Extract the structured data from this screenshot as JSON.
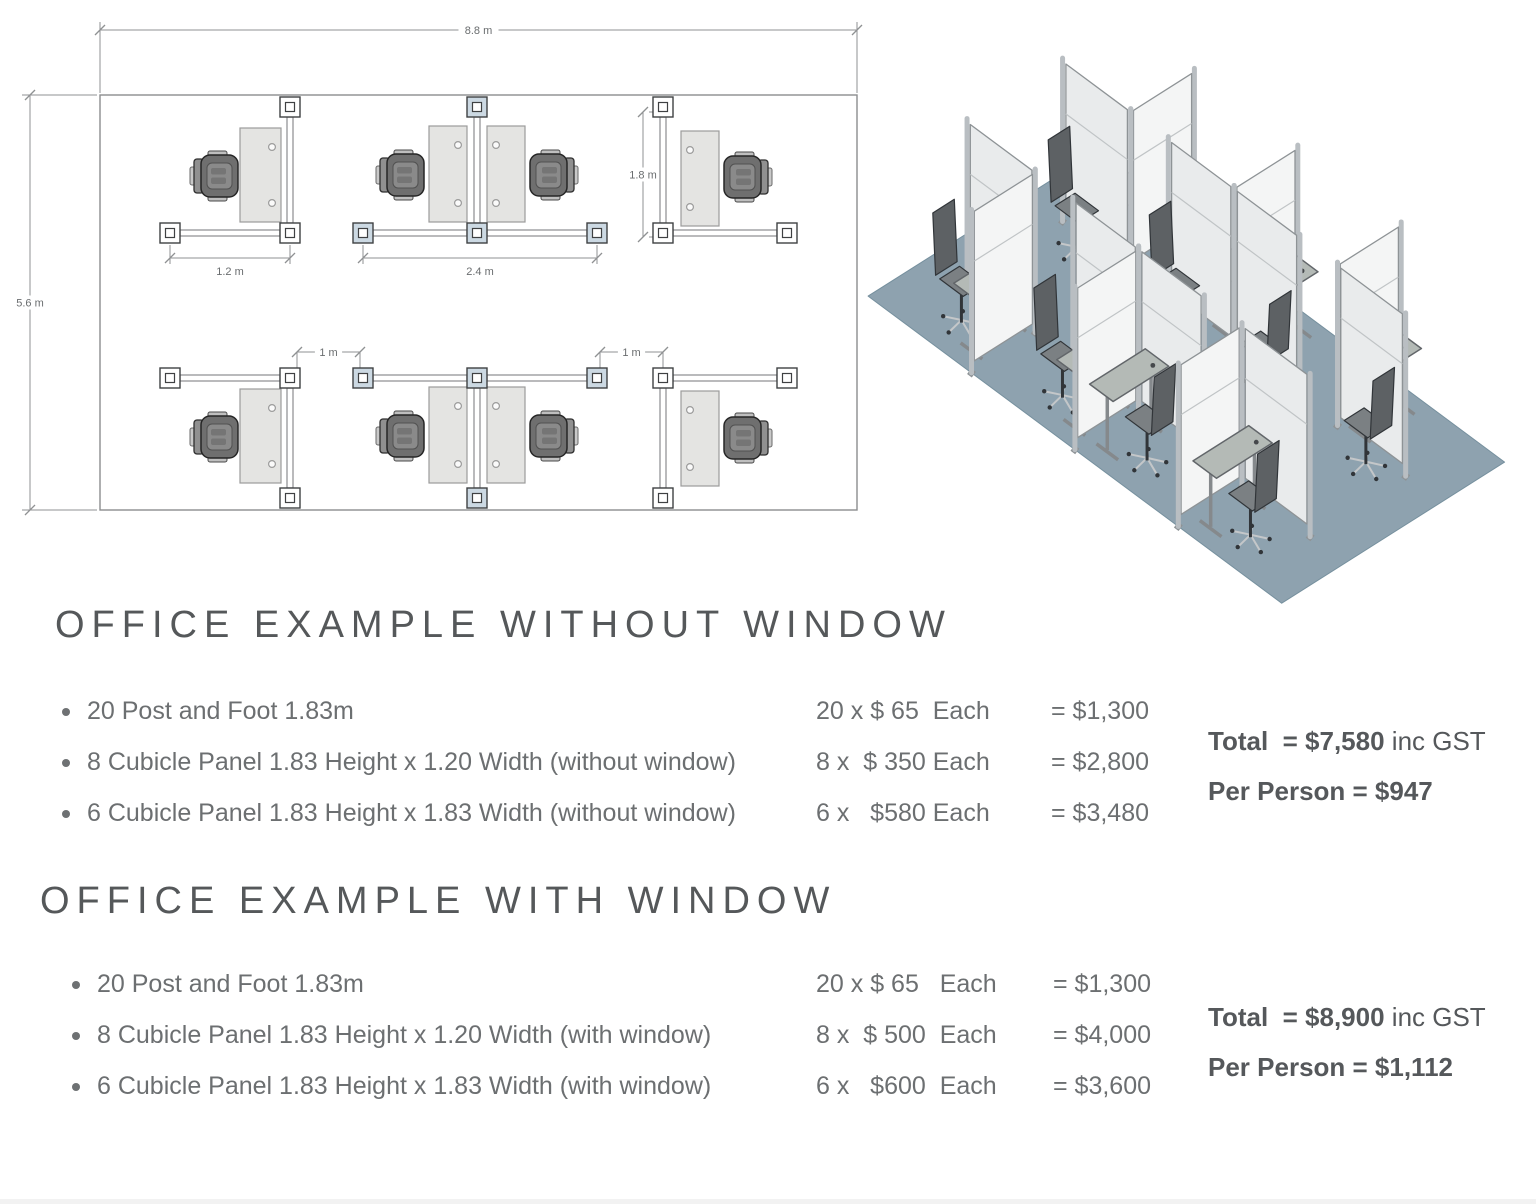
{
  "floor_plan": {
    "room": {
      "x": 100,
      "y": 95,
      "w": 757,
      "h": 415
    },
    "colors": {
      "line": "#8b8d8f",
      "dim": "#8f9193",
      "text": "#6a6d6f",
      "post_line": "#3f4143",
      "post_shaded": "#ccd9e3",
      "desk": "#e4e4e2",
      "desk_line": "#9b9b9b"
    },
    "dims": [
      {
        "x1": 100,
        "y1": 30,
        "x2": 857,
        "y2": 30,
        "label": "8.8 m",
        "ext": [
          [
            100,
            22,
            100,
            93
          ],
          [
            857,
            22,
            857,
            93
          ]
        ]
      },
      {
        "x1": 30,
        "y1": 95,
        "x2": 30,
        "y2": 510,
        "label": "5.6 m",
        "ext": [
          [
            22,
            95,
            97,
            95
          ],
          [
            22,
            510,
            97,
            510
          ]
        ]
      },
      {
        "x1": 170,
        "y1": 258,
        "x2": 290,
        "y2": 258,
        "label": "1.2 m",
        "below": true,
        "ext": [
          [
            170,
            245,
            170,
            264
          ],
          [
            290,
            245,
            290,
            264
          ]
        ]
      },
      {
        "x1": 363,
        "y1": 258,
        "x2": 597,
        "y2": 258,
        "label": "2.4 m",
        "below": true,
        "ext": [
          [
            363,
            245,
            363,
            264
          ],
          [
            597,
            245,
            597,
            264
          ]
        ]
      },
      {
        "x1": 643,
        "y1": 112,
        "x2": 643,
        "y2": 237,
        "label": "1.8 m",
        "ext": [
          [
            649,
            112,
            671,
            112
          ],
          [
            649,
            237,
            671,
            237
          ]
        ]
      },
      {
        "x1": 297,
        "y1": 352,
        "x2": 360,
        "y2": 352,
        "label": "1 m",
        "ext": [
          [
            297,
            352,
            297,
            370
          ],
          [
            360,
            352,
            360,
            370
          ]
        ]
      },
      {
        "x1": 600,
        "y1": 352,
        "x2": 663,
        "y2": 352,
        "label": "1 m",
        "ext": [
          [
            600,
            352,
            600,
            370
          ],
          [
            663,
            352,
            663,
            370
          ]
        ]
      }
    ],
    "panels": [
      [
        290,
        117,
        290,
        223
      ],
      [
        477,
        117,
        477,
        223
      ],
      [
        663,
        117,
        663,
        223
      ],
      [
        180,
        233,
        280,
        233
      ],
      [
        373,
        233,
        467,
        233
      ],
      [
        487,
        233,
        587,
        233
      ],
      [
        673,
        233,
        777,
        233
      ],
      [
        290,
        388,
        290,
        488
      ],
      [
        477,
        388,
        477,
        488
      ],
      [
        663,
        388,
        663,
        488
      ],
      [
        180,
        378,
        280,
        378
      ],
      [
        373,
        378,
        467,
        378
      ],
      [
        487,
        378,
        587,
        378
      ],
      [
        673,
        378,
        777,
        378
      ]
    ],
    "posts": [
      [
        290,
        107,
        0
      ],
      [
        477,
        107,
        1
      ],
      [
        663,
        107,
        0
      ],
      [
        170,
        233,
        0
      ],
      [
        290,
        233,
        0
      ],
      [
        363,
        233,
        1
      ],
      [
        477,
        233,
        1
      ],
      [
        597,
        233,
        1
      ],
      [
        663,
        233,
        0
      ],
      [
        787,
        233,
        0
      ],
      [
        170,
        378,
        0
      ],
      [
        290,
        378,
        0
      ],
      [
        363,
        378,
        1
      ],
      [
        477,
        378,
        1
      ],
      [
        597,
        378,
        1
      ],
      [
        663,
        378,
        0
      ],
      [
        787,
        378,
        0
      ],
      [
        290,
        498,
        0
      ],
      [
        477,
        498,
        1
      ],
      [
        663,
        498,
        0
      ]
    ],
    "desks": [
      [
        240,
        128,
        41,
        94,
        "r"
      ],
      [
        429,
        126,
        38,
        96,
        "r"
      ],
      [
        487,
        126,
        38,
        96,
        "l"
      ],
      [
        681,
        131,
        38,
        95,
        "l"
      ],
      [
        240,
        389,
        41,
        94,
        "r"
      ],
      [
        429,
        387,
        38,
        96,
        "r"
      ],
      [
        487,
        387,
        38,
        96,
        "l"
      ],
      [
        681,
        391,
        38,
        95,
        "l"
      ]
    ],
    "chairs": [
      [
        217,
        176,
        0
      ],
      [
        403,
        175,
        0
      ],
      [
        551,
        175,
        180
      ],
      [
        745,
        177,
        180
      ],
      [
        217,
        437,
        0
      ],
      [
        403,
        436,
        0
      ],
      [
        551,
        436,
        180
      ],
      [
        745,
        438,
        180
      ]
    ]
  },
  "iso_view": {
    "proj": {
      "ox": 251,
      "oy": 115,
      "ax": 47.0,
      "ay": 34.9,
      "bx": 39.8,
      "by": 25.2,
      "hz": 86
    },
    "floor": [
      [
        0,
        0
      ],
      [
        8.8,
        0
      ],
      [
        8.8,
        5.6
      ],
      [
        0,
        5.6
      ]
    ],
    "colors": {
      "floor": "#8ea2af",
      "floor_line": "#76909e",
      "panel_front": "#e9ebec",
      "panel_side": "#f4f5f5",
      "panel_line": "#8e9396",
      "seam": "#c0c4c6",
      "post": "#b9bec2",
      "post_dark": "#8e9396",
      "desk": "#b4bab6",
      "desk_line": "#62666a",
      "leg": "#85898c",
      "chair_seat": "#7b8083",
      "chair_back": "#5d6164",
      "chair_dark": "#313539",
      "chair_base": "#c4c7c9"
    },
    "panels": [
      [
        2.2,
        0,
        2.2,
        1.6
      ],
      [
        4.4,
        0,
        4.4,
        1.6
      ],
      [
        6.6,
        0,
        6.6,
        1.6
      ],
      [
        0.75,
        1.6,
        2.2,
        1.6
      ],
      [
        3.0,
        1.6,
        4.4,
        1.6
      ],
      [
        4.4,
        1.6,
        5.8,
        1.6
      ],
      [
        6.6,
        1.6,
        8.05,
        1.6
      ],
      [
        2.2,
        4,
        2.2,
        5.6
      ],
      [
        4.4,
        4,
        4.4,
        5.6
      ],
      [
        6.6,
        4,
        6.6,
        5.6
      ],
      [
        0.75,
        4,
        2.2,
        4
      ],
      [
        3.0,
        4,
        4.4,
        4
      ],
      [
        4.4,
        4,
        5.8,
        4
      ],
      [
        6.6,
        4,
        8.05,
        4
      ]
    ],
    "desks": [
      [
        1.86,
        0.9
      ],
      [
        4.05,
        0.9
      ],
      [
        4.75,
        0.9
      ],
      [
        6.95,
        0.9
      ],
      [
        1.86,
        4.65
      ],
      [
        4.05,
        4.65
      ],
      [
        4.75,
        4.65
      ],
      [
        6.95,
        4.65
      ]
    ],
    "chairs": [
      [
        1.35,
        1.95,
        1
      ],
      [
        3.5,
        1.95,
        1
      ],
      [
        5.3,
        1.95,
        -1
      ],
      [
        7.5,
        1.95,
        -1
      ],
      [
        1.35,
        4.85,
        1
      ],
      [
        3.5,
        4.85,
        1
      ],
      [
        5.3,
        4.85,
        -1
      ],
      [
        7.5,
        4.85,
        -1
      ]
    ]
  },
  "sections": [
    {
      "title": "OFFICE EXAMPLE WITHOUT WINDOW",
      "items": [
        {
          "desc": "20 Post and Foot 1.83m",
          "qty": "20 x $ 65  Each",
          "total": "= $1,300"
        },
        {
          "desc": "8 Cubicle Panel 1.83 Height x 1.20 Width (without window)",
          "qty": "8 x  $ 350 Each",
          "total": "= $2,800"
        },
        {
          "desc": "6 Cubicle Panel 1.83 Height x 1.83 Width (without window)",
          "qty": "6 x   $580 Each",
          "total": "= $3,480"
        }
      ],
      "summary": {
        "total_bold": "Total  = $7,580",
        "total_suffix": " inc GST",
        "per_bold": "Per Person = $947"
      }
    },
    {
      "title": "OFFICE EXAMPLE WITH WINDOW",
      "items": [
        {
          "desc": "20 Post and Foot 1.83m",
          "qty": "20 x $ 65   Each",
          "total": "= $1,300"
        },
        {
          "desc": "8 Cubicle Panel 1.83 Height x 1.20 Width (with window)",
          "qty": "8 x  $ 500  Each",
          "total": "= $4,000"
        },
        {
          "desc": "6 Cubicle Panel 1.83 Height x 1.83 Width (with window)",
          "qty": "6 x   $600  Each",
          "total": "= $3,600"
        }
      ],
      "summary": {
        "total_bold": "Total  = $8,900",
        "total_suffix": " inc GST",
        "per_bold": "Per Person = $1,112"
      }
    }
  ]
}
